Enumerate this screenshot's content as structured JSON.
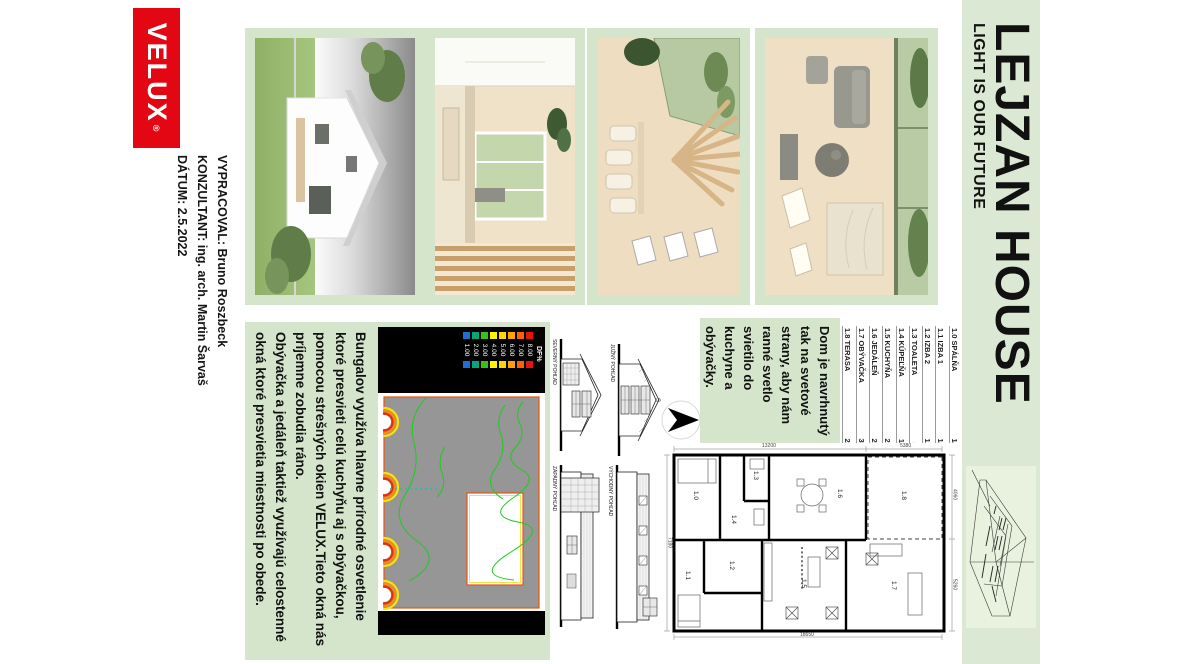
{
  "brand": {
    "logo_text": "VELUX",
    "registered_mark": "®",
    "red": "#e30613"
  },
  "credits": {
    "lines": [
      "VYPRACOVAL: Bruno Roszbeck",
      "KONZULTANT: ing. arch. Martin Šarvaš",
      "DÁTUM: 2.5.2022"
    ]
  },
  "title": {
    "main": "LEJZAN HOUSE",
    "subtitle": "LIGHT IS OUR FUTURE"
  },
  "paragraphs": {
    "daylight_lines": [
      "Bungalov využíva hlavne prírodné osvetlenie",
      "ktoré presvieti celú kuchyňu aj s obývačkou,",
      "pomocou strešných okien VELUX.Tieto okná nás",
      "príjemne zobudia ráno.",
      "Obývačka a jedáleň taktiež využívajú celostenné",
      "okná ktoré presvietia miestnosti po obede."
    ],
    "orientation_lines": [
      "Dom je navrhnutý",
      "tak na svetové",
      "strany, aby nám",
      "ranné svetlo",
      "svietilo do",
      "kuchyne a",
      "obývačky."
    ]
  },
  "legend_rooms": [
    {
      "id": "1.0",
      "name": "SPÁLŇA",
      "area": "14m²"
    },
    {
      "id": "1.1",
      "name": "IZBA 1",
      "area": "14m²"
    },
    {
      "id": "1.2",
      "name": "IZBA 2",
      "area": "12m²"
    },
    {
      "id": "1.3",
      "name": "TOALETA",
      "area": "3m²"
    },
    {
      "id": "1.4",
      "name": "KÚPEĽŇA",
      "area": "11m²"
    },
    {
      "id": "1.5",
      "name": "KUCHYŇA",
      "area": "27m²"
    },
    {
      "id": "1.6",
      "name": "JEDÁLEŇ",
      "area": "26m²"
    },
    {
      "id": "1.7",
      "name": "OBÝVAČKA",
      "area": "30m²"
    },
    {
      "id": "1.8",
      "name": "TERASA",
      "area": "23m²"
    }
  ],
  "df_legend": {
    "title": "DF%",
    "entries": [
      {
        "value": "8.00",
        "color": "#e81309"
      },
      {
        "value": "7.00",
        "color": "#ff6000"
      },
      {
        "value": "6.00",
        "color": "#ffa200"
      },
      {
        "value": "5.00",
        "color": "#ffd400"
      },
      {
        "value": "4.00",
        "color": "#fdf500"
      },
      {
        "value": "3.00",
        "color": "#35c21d"
      },
      {
        "value": "2.00",
        "color": "#00a878"
      },
      {
        "value": "1.00",
        "color": "#1d6fd1"
      }
    ]
  },
  "elevations": [
    "SEVERNÝ POHĽAD",
    "JUŽNÝ POHĽAD",
    "ZÁPADNÝ POHĽAD",
    "VÝCHODNÝ POHĽAD"
  ],
  "floor_plan": {
    "rooms": [
      "1.0",
      "1.1",
      "1.2",
      "1.3",
      "1.4",
      "1.5",
      "1.6",
      "1.7",
      "1.8"
    ],
    "dimensions": {
      "left_upper": "5380",
      "left_lower": "13200",
      "right": "18650",
      "top_left": "4060",
      "top_right": "5260",
      "bottom": "7180"
    }
  },
  "north_label": "S"
}
